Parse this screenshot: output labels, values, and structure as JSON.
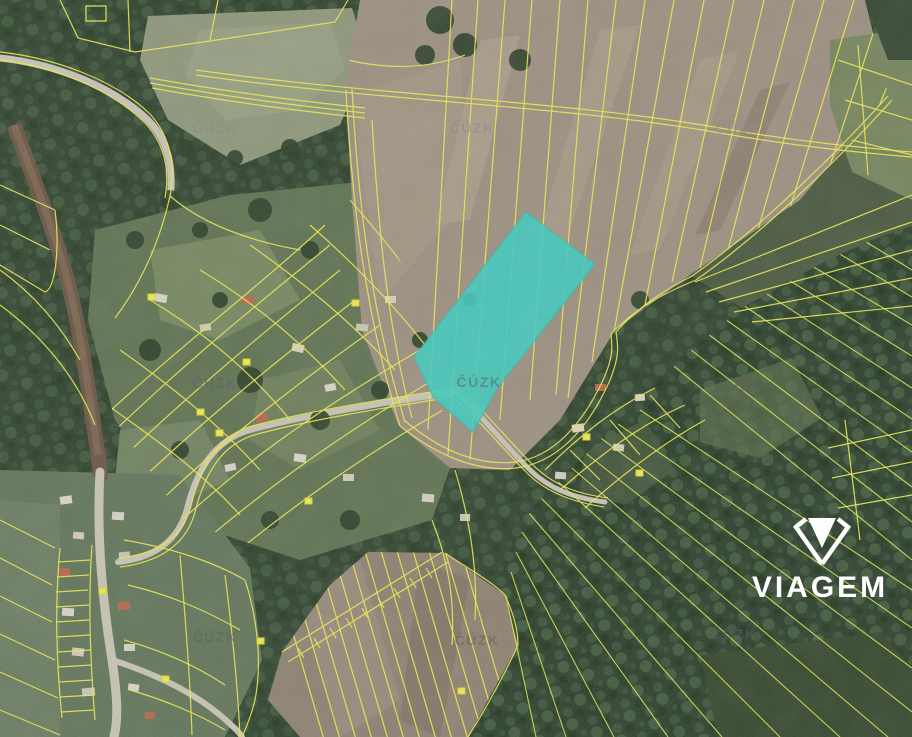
{
  "watermark": {
    "text": "ČÚZK"
  },
  "logo": {
    "text": "VIAGEM"
  },
  "map": {
    "type": "cadastral-aerial-view",
    "highlight_color": "#3fcabe",
    "parcel_line_color": "#e9e84f",
    "highlighted_parcel_polygon": "526,212 595,264 498,387 473,432 433,397 414,357"
  }
}
